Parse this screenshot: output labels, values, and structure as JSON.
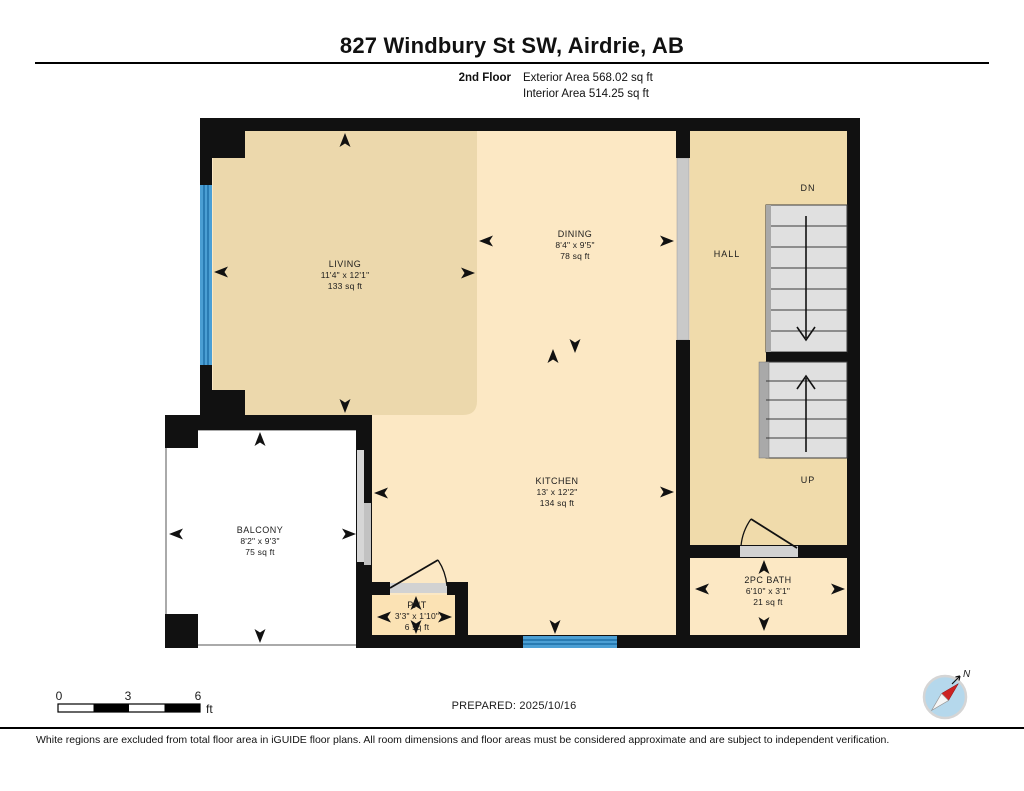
{
  "header": {
    "title": "827 Windbury St SW, Airdrie, AB",
    "floor_label": "2nd Floor",
    "exterior_area": "Exterior Area 568.02 sq ft",
    "interior_area": "Interior Area 514.25 sq ft"
  },
  "rooms": {
    "living": {
      "name": "LIVING",
      "dims": "11'4\" x 12'1\"",
      "area": "133 sq ft"
    },
    "dining": {
      "name": "DINING",
      "dims": "8'4\" x 9'5\"",
      "area": "78 sq ft"
    },
    "kitchen": {
      "name": "KITCHEN",
      "dims": "13' x 12'2\"",
      "area": "134 sq ft"
    },
    "balcony": {
      "name": "BALCONY",
      "dims": "8'2\" x 9'3\"",
      "area": "75 sq ft"
    },
    "pantry": {
      "name": "PNT",
      "dims": "3'3\" x 1'10\"",
      "area": "6 sq ft"
    },
    "bath": {
      "name": "2PC BATH",
      "dims": "6'10\" x 3'1\"",
      "area": "21 sq ft"
    },
    "hall": {
      "name": "HALL"
    }
  },
  "stairs": {
    "down_label": "DN",
    "up_label": "UP"
  },
  "scale_bar": {
    "tick0": "0",
    "tick1": "3",
    "tick2": "6",
    "unit": "ft"
  },
  "compass": {
    "north_label": "N"
  },
  "footer": {
    "prepared": "PREPARED: 2025/10/16",
    "disclaimer": "White regions are excluded from total floor area in iGUIDE floor plans. All room dimensions and floor areas must be considered approximate and are subject to independent verification."
  },
  "colors": {
    "wall": "#111111",
    "living_fill": "#ecd8ac",
    "hall_fill": "#f0dbab",
    "kitchen_fill": "#fce8c4",
    "pantry_fill": "#fbe2b4",
    "balcony_fill": "#ffffff",
    "window_blue": "#4b9fd4",
    "stairs_gray": "#e0e0e0",
    "railing_gray": "#a9a9a9",
    "compass_red": "#cc2222",
    "compass_blue": "#b5d8ec"
  }
}
